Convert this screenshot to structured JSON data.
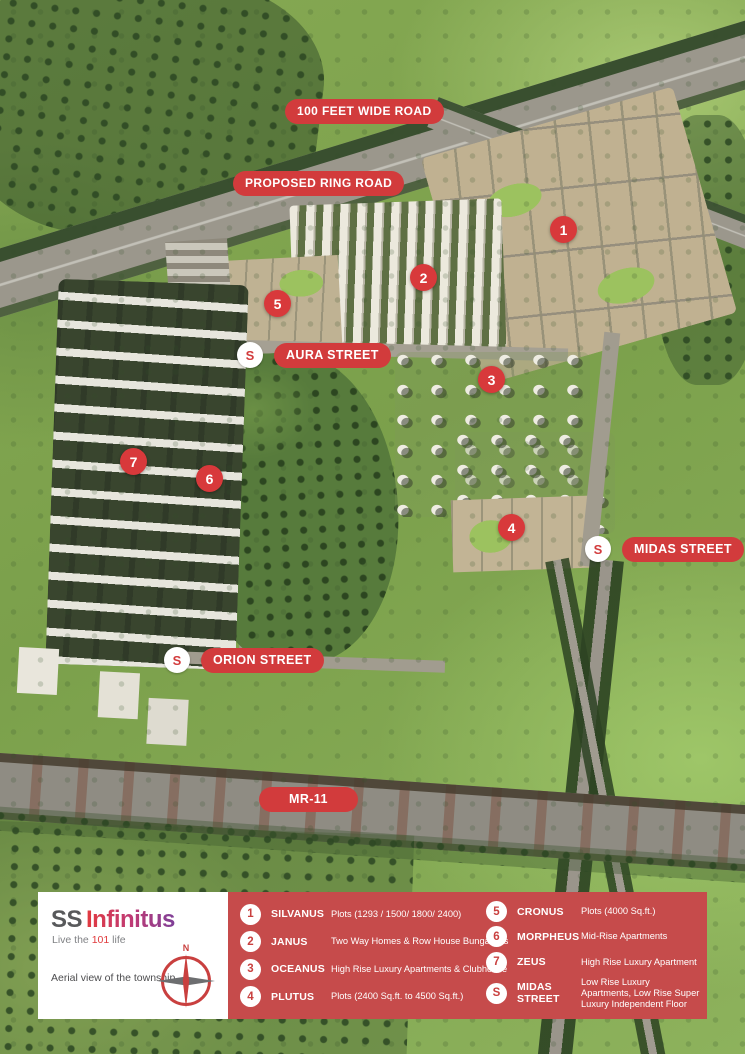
{
  "map": {
    "road_labels": [
      {
        "text": "100 FEET WIDE ROAD"
      },
      {
        "text": "PROPOSED RING ROAD"
      },
      {
        "text": "MR-11"
      }
    ],
    "street_labels": [
      {
        "marker": "S",
        "text": "AURA STREET"
      },
      {
        "marker": "S",
        "text": "MIDAS STREET"
      },
      {
        "marker": "S",
        "text": "ORION STREET"
      }
    ],
    "markers": [
      "1",
      "2",
      "3",
      "4",
      "5",
      "6",
      "7"
    ]
  },
  "legend": {
    "items": [
      {
        "marker": "1",
        "name": "SILVANUS",
        "desc": "Plots (1293 / 1500/ 1800/ 2400)"
      },
      {
        "marker": "2",
        "name": "JANUS",
        "desc": "Two Way Homes & Row House Bungalows"
      },
      {
        "marker": "3",
        "name": "OCEANUS",
        "desc": "High Rise Luxury Apartments & Clubhouse"
      },
      {
        "marker": "4",
        "name": "PLUTUS",
        "desc": "Plots (2400 Sq.ft. to 4500 Sq.ft.)"
      },
      {
        "marker": "5",
        "name": "CRONUS",
        "desc": "Plots (4000 Sq.ft.)"
      },
      {
        "marker": "6",
        "name": "MORPHEUS",
        "desc": "Mid-Rise Apartments"
      },
      {
        "marker": "7",
        "name": "ZEUS",
        "desc": "High Rise Luxury Apartment"
      },
      {
        "marker": "S",
        "name": "MIDAS STREET",
        "desc": "Low Rise Luxury Apartments, Low Rise Super Luxury Independent Floor"
      }
    ]
  },
  "branding": {
    "logo_primary": "SS",
    "logo_secondary": "Infinitus",
    "tagline_pre": "Live the ",
    "tagline_highlight": "101",
    "tagline_post": " life",
    "caption": "Aerial view of the township",
    "compass_label": "N"
  },
  "colors": {
    "accent_red": "#d23b3c",
    "panel_red": "#c64b4b",
    "logo_gray": "#58595b",
    "logo_purple": "#7e3f98",
    "field_green": "#87aa55"
  }
}
